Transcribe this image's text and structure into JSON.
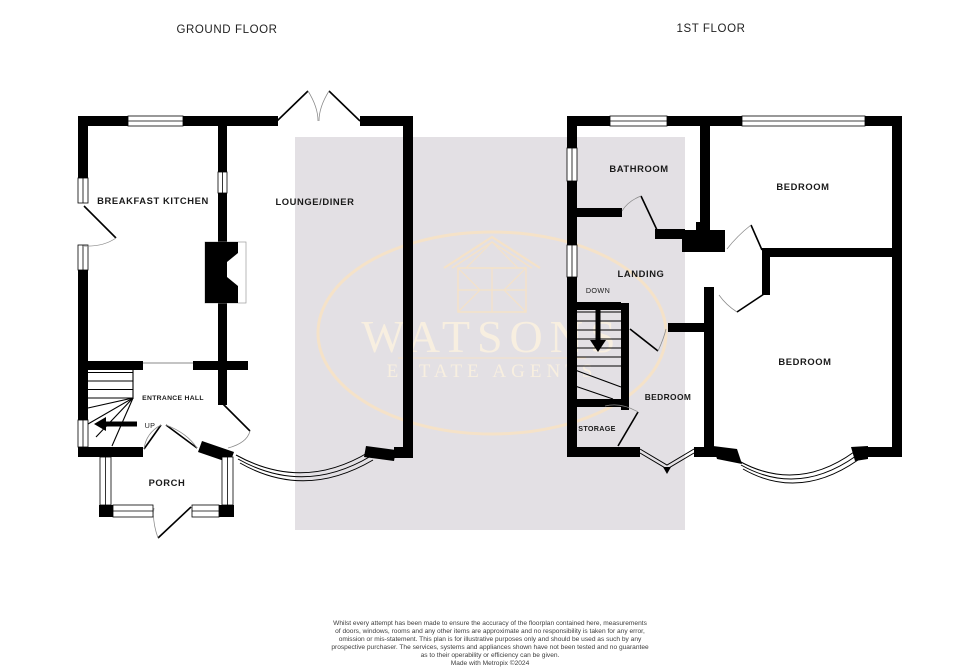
{
  "titles": {
    "ground_floor": "GROUND FLOOR",
    "first_floor": "1ST FLOOR"
  },
  "ground_floor": {
    "labels": {
      "breakfast_kitchen": "BREAKFAST KITCHEN",
      "lounge_diner": "LOUNGE/DINER",
      "entrance_hall": "ENTRANCE HALL",
      "up": "UP",
      "porch": "PORCH"
    }
  },
  "first_floor": {
    "labels": {
      "bathroom": "BATHROOM",
      "bedroom_top": "BEDROOM",
      "landing": "LANDING",
      "down": "DOWN",
      "bedroom_right": "BEDROOM",
      "bedroom_middle": "BEDROOM",
      "storage": "STORAGE"
    }
  },
  "watermark": {
    "name": "WATSONS",
    "tagline": "ESTATE AGENTS"
  },
  "colors": {
    "wall": "#000000",
    "watermark_bg": "#e3e0e4",
    "watermark_line": "#f5e2c8",
    "watermark_text": "#f8efe0",
    "label": "#1a1a1a",
    "title": "#222222",
    "footer": "#3d3d3d"
  },
  "footer": {
    "lines": [
      "Whilst every attempt has been made to ensure the accuracy of the floorplan contained here, measurements",
      "of doors, windows, rooms and any other items are approximate and no responsibility is taken for any error,",
      "omission or mis-statement. This plan is for illustrative purposes only and should be used as such by any",
      "prospective purchaser. The services, systems and appliances shown have not been tested and no guarantee",
      "as to their operability or efficiency can be given.",
      "Made with Metropix ©2024"
    ]
  }
}
